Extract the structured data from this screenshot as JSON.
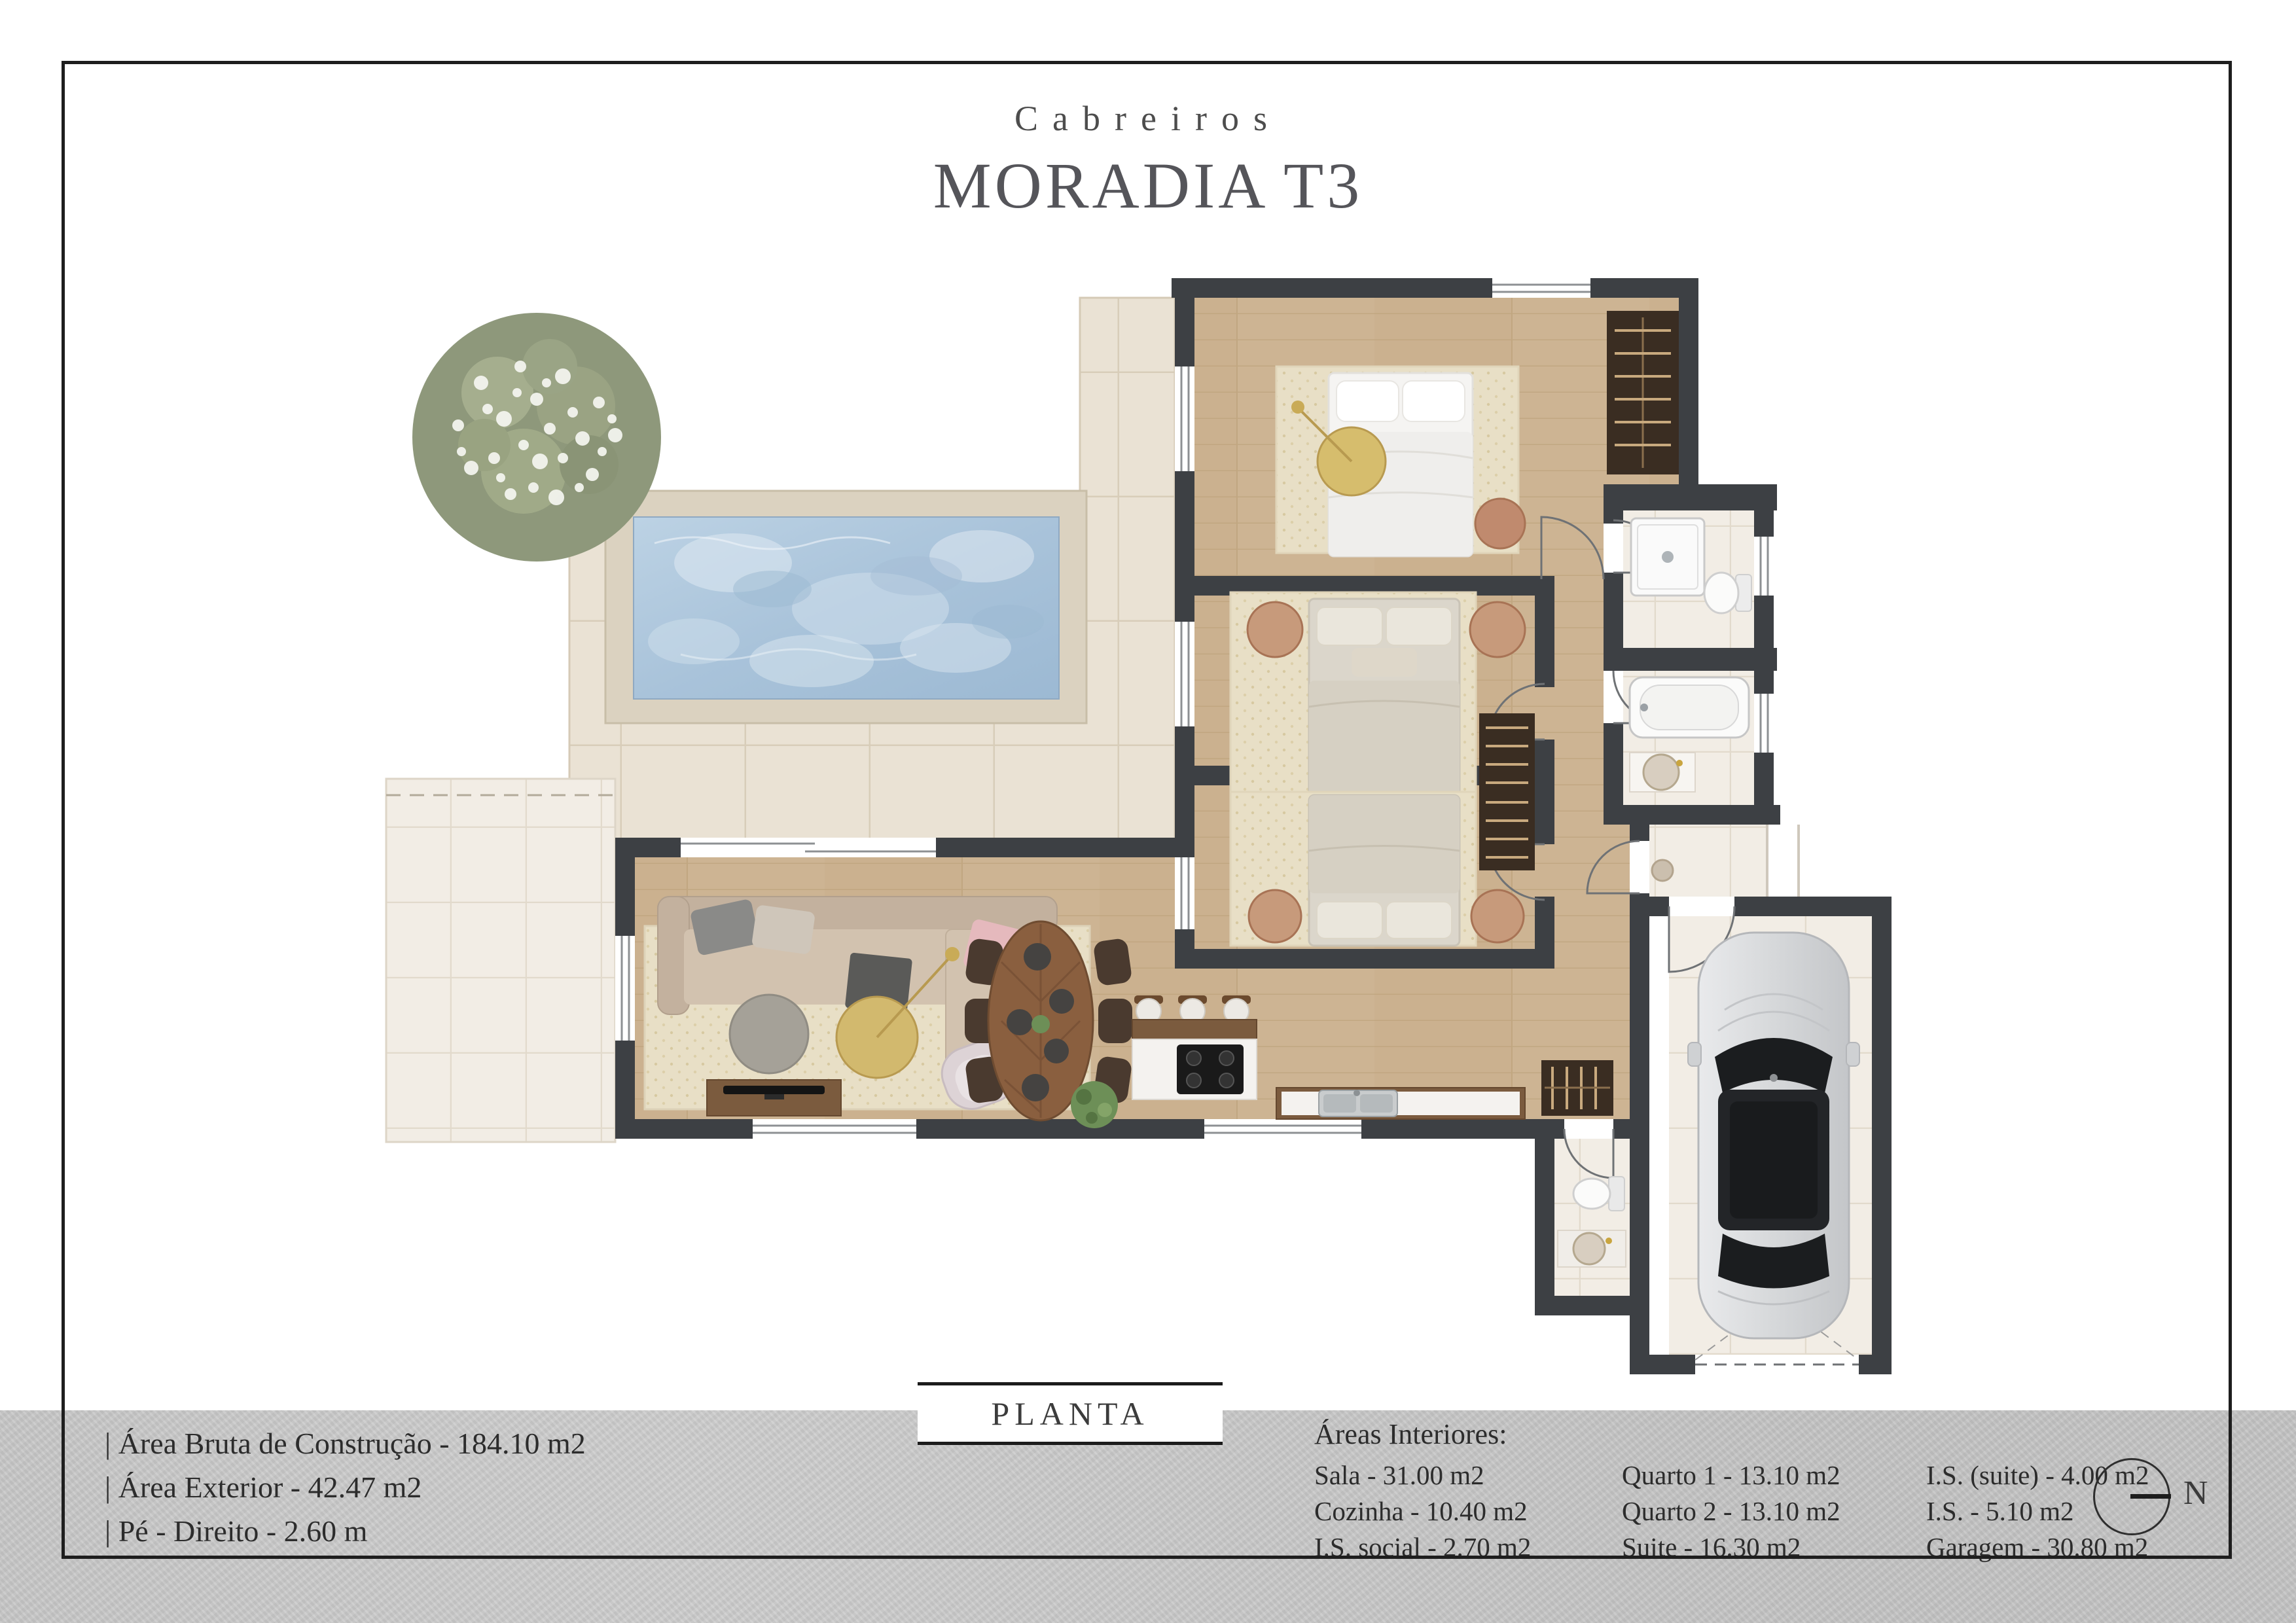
{
  "title": {
    "brand": "Cabreiros",
    "name": "MORADIA T3"
  },
  "plan_label": "PLANTA",
  "specs": [
    "| Área Bruta de Construção - 184.10 m2",
    "| Área Exterior - 42.47 m2",
    "| Pé - Direito - 2.60 m"
  ],
  "areas": {
    "header": "Áreas Interiores:",
    "col1": [
      "Sala - 31.00 m2",
      "Cozinha - 10.40 m2",
      "I.S. social - 2.70 m2"
    ],
    "col2": [
      "Quarto 1 - 13.10 m2",
      "Quarto 2 - 13.10 m2",
      "Suite - 16.30 m2"
    ],
    "col3": [
      "I.S. (suite) - 4.00 m2",
      "I.S. - 5.10 m2",
      "Garagem - 30.80 m2"
    ]
  },
  "compass": {
    "label": "N"
  },
  "colors": {
    "wall": "#3d4044",
    "wood_floor": "#cdb493",
    "deck_tile": "#eae2d4",
    "light_tile": "#f2ede5",
    "pool_water": "#a9c3da",
    "band": "#c7c7c7",
    "wardrobe": "#3a2d22"
  }
}
